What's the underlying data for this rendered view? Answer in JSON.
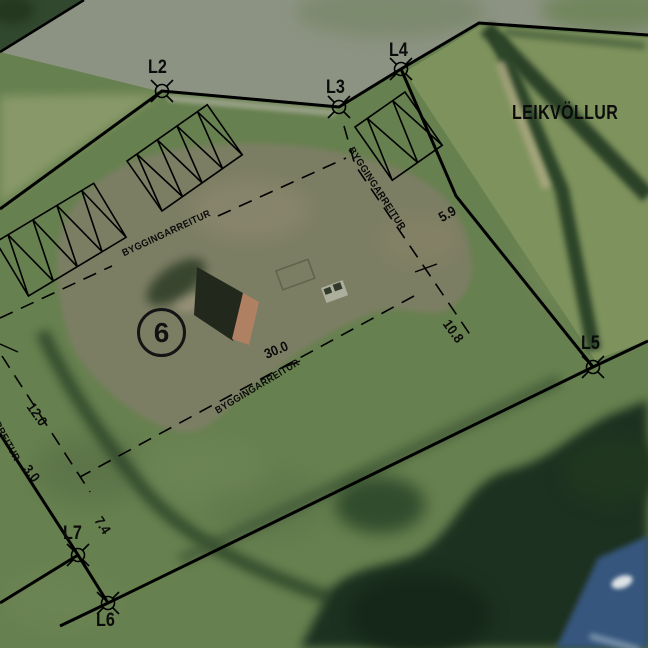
{
  "map": {
    "area_label": "LEIKVÖLLUR",
    "lot_number": "6",
    "building_plot_label": "BYGGINGARREITUR",
    "survey_points": [
      {
        "label": "L2"
      },
      {
        "label": "L3"
      },
      {
        "label": "L4"
      },
      {
        "label": "L5"
      },
      {
        "label": "L6"
      },
      {
        "label": "L7"
      }
    ],
    "dimensions": [
      {
        "label": "5.9"
      },
      {
        "label": "10.8"
      },
      {
        "label": "30.0"
      },
      {
        "label": "12.0"
      },
      {
        "label": "3.0"
      },
      {
        "label": "7.4"
      }
    ],
    "colors": {
      "linework": "#000000",
      "grass": "#67804f",
      "road": "#8d9383",
      "playfield": "#7e925d",
      "gravel": "#7e7e66",
      "hedge_dark": "#2b4127",
      "trees": "#1d3120",
      "water": "#36567d",
      "house_roof": "#23281d",
      "house_wall": "#b08063"
    }
  }
}
